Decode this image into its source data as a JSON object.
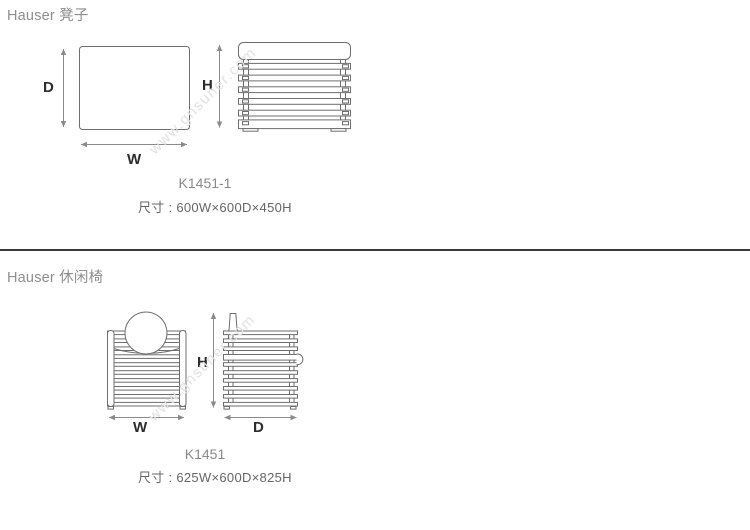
{
  "page": {
    "watermark_text": "www.gnsuner.com",
    "colors": {
      "background": "#ffffff",
      "drawing_line": "#6e6e6e",
      "arrow_line": "#8a8a8a",
      "dim_label": "#2d2d2d",
      "section_title": "#8e8e8e",
      "product_code": "#8a8a8a",
      "size_text": "#666666",
      "divider": "#3a3a3a",
      "watermark": "#e2e2e2"
    }
  },
  "sections": [
    {
      "title": "Hauser 凳子",
      "code": "K1451-1",
      "size_line": "尺寸 : 600W×600D×450H",
      "labels": {
        "depth": "D",
        "width": "W",
        "height": "H"
      }
    },
    {
      "title": "Hauser 休闲椅",
      "code": "K1451",
      "size_line": "尺寸 : 625W×600D×825H",
      "labels": {
        "width": "W",
        "height": "H",
        "depth": "D"
      }
    }
  ]
}
